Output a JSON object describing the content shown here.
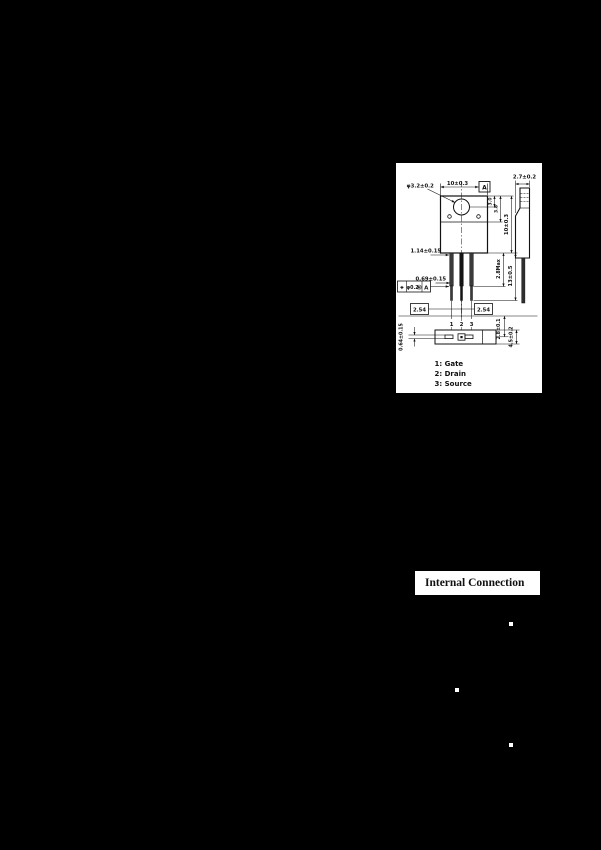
{
  "page": {
    "background": "#000000",
    "panel_background": "#ffffff",
    "ink": "#111111"
  },
  "package_drawing": {
    "top": {
      "hole_diameter": "φ3.2±0.2",
      "body_width": "10±0.3",
      "datum": "A"
    },
    "right": {
      "hole_to_top": "3.0",
      "tab_to_top": "3.8",
      "body_height": "10±0.3",
      "shoulder_max": "2.8Max",
      "lead_length": "13±0.5"
    },
    "left": {
      "lead_width_upper": "1.14±0.15",
      "lead_width_tip": "0.69±0.15",
      "position_symbol": "⌖",
      "position_tolerance": "φ0.2",
      "material_modifier": "Ⓜ",
      "position_datum": "A"
    },
    "pitch": {
      "left_box": "2.54",
      "right_box": "2.54"
    },
    "bottom_view": {
      "lead_thickness": "0.64±0.15",
      "pad_offset": "2.8±0.1",
      "body_depth": "4.5±0.2",
      "pin_numbers": [
        "1",
        "2",
        "3"
      ]
    },
    "side": {
      "thickness": "2.7±0.2"
    },
    "legend": [
      "1: Gate",
      "2: Drain",
      "3: Source"
    ]
  },
  "internal_connection": {
    "title": "Internal Connection"
  }
}
